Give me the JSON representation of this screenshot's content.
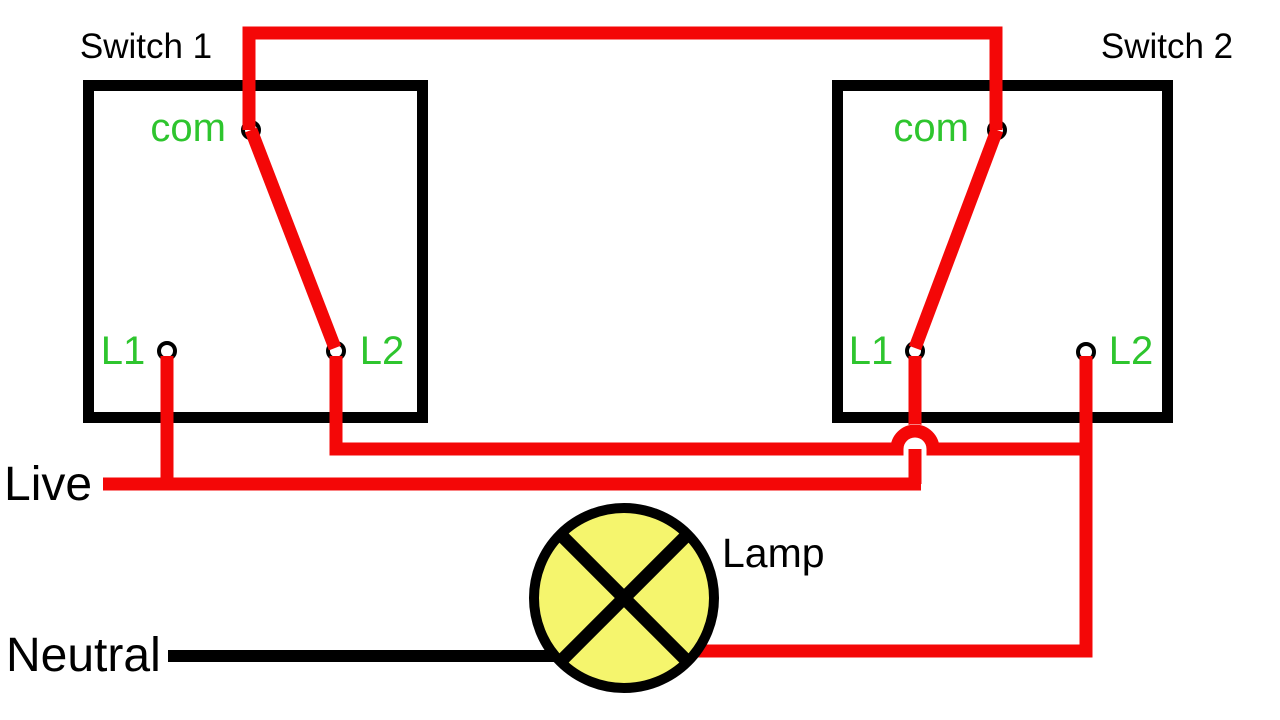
{
  "colors": {
    "wire_red": "#f40707",
    "wire_black": "#000000",
    "terminal_green": "#2ec52e",
    "lamp_yellow": "#f5f56d",
    "text_black": "#000000",
    "background": "#ffffff"
  },
  "switch1": {
    "title": "Switch 1",
    "terminal_com": "com",
    "terminal_l1": "L1",
    "terminal_l2": "L2"
  },
  "switch2": {
    "title": "Switch 2",
    "terminal_com": "com",
    "terminal_l1": "L1",
    "terminal_l2": "L2"
  },
  "labels": {
    "live": "Live",
    "neutral": "Neutral",
    "lamp": "Lamp"
  },
  "connections": [
    {
      "from": "switch1-com",
      "to": "switch2-com",
      "color": "red"
    },
    {
      "from": "switch1-com",
      "to": "switch1-l2",
      "color": "red"
    },
    {
      "from": "switch2-com",
      "to": "switch2-l1",
      "color": "red"
    },
    {
      "from": "live-feed",
      "to": "switch1-l1",
      "color": "red"
    },
    {
      "from": "live-feed",
      "to": "switch2-l1",
      "color": "red"
    },
    {
      "from": "switch1-l2",
      "to": "switch2-l2",
      "color": "red"
    },
    {
      "from": "switch2-l2",
      "to": "lamp",
      "color": "red"
    },
    {
      "from": "neutral-feed",
      "to": "lamp",
      "color": "black"
    }
  ]
}
